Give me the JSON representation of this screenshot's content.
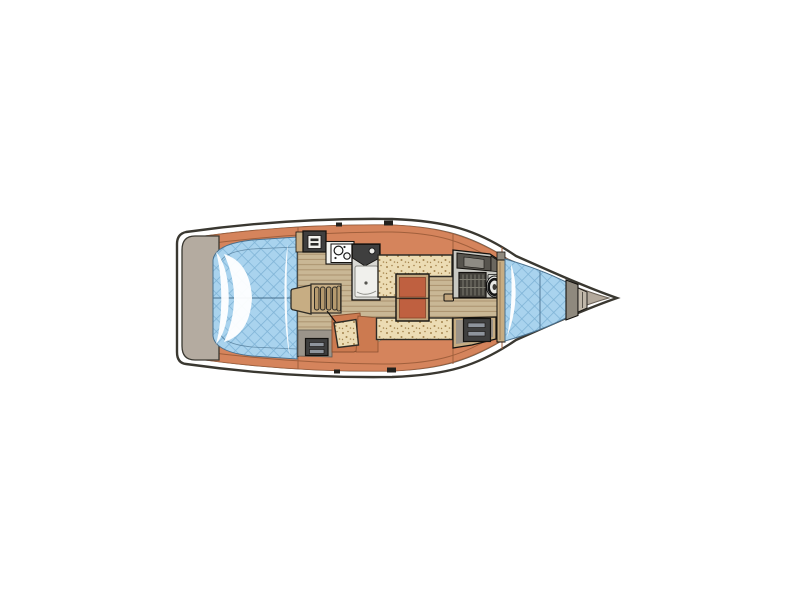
{
  "canvas": {
    "width": 800,
    "height": 600,
    "background": "#ffffff"
  },
  "diagram_type": "sailboat-interior-floor-plan",
  "orientation": {
    "bow": "right",
    "stern": "left"
  },
  "colors": {
    "outline": "#3a3831",
    "inner_line": "#6b6257",
    "hull_white": "#ffffff",
    "deck": "#d5845c",
    "deck_dark": "#cc7a50",
    "deck_line": "#a05f3c",
    "bow_deck": "#b3a99c",
    "transom": "#b4aba0",
    "cushion": "#a9d3ee",
    "cushion_grid": "#7fb3d6",
    "cushion_edge": "#49708e",
    "highlight_white": "#ffffff",
    "floor": "#c9b795",
    "floor_line": "#a78e6a",
    "settee": "#ecdcb4",
    "speckle_dot": "#a5854f",
    "table_top": "#bf6040",
    "table_edge": "#8a4328",
    "table_frame": "#c2a57c",
    "dark_unit": "#3f3f3f",
    "metal_bar": "#8e949c",
    "gray_floor": "#9b948a",
    "head_floor": "#d9d9d4",
    "fwd_head_floor": "#c8c8c2",
    "wood_trim": "#c7ad83",
    "wood_dark": "#b59a6e",
    "grate": "#44423c",
    "grate_line": "#7d7b70",
    "locker_gray": "#8f897e",
    "wc_white": "#e9e9e5",
    "cabinet_dark": "#57544e",
    "cabinet_panel": "#8e8b84",
    "step_taupe": "#c0b7a9",
    "icon_white": "#f2f2ee",
    "counter_white": "#f4f4f0",
    "fitting_black": "#23211d"
  },
  "regions": {
    "hull": "hull-outline",
    "swim_platform": "stern-swim-platform",
    "cockpit": "cockpit-cushions",
    "companionway": "companionway-steps",
    "galley": "galley",
    "stove": "stove-oven",
    "sink": "galley-sink",
    "aft_head": "aft-head-shower",
    "saloon": "saloon",
    "settee_top": "starboard-settee",
    "settee_bottom": "port-settee",
    "nav_seat": "aft-seat",
    "table": "saloon-table",
    "engine_box": "engine-locker",
    "forward_head": "forward-head",
    "toilet": "toilet",
    "shower_grate": "shower-grate",
    "wardrobe": "forward-locker",
    "v_berth": "v-berth-cushion",
    "anchor_locker": "bow-anchor-locker"
  }
}
